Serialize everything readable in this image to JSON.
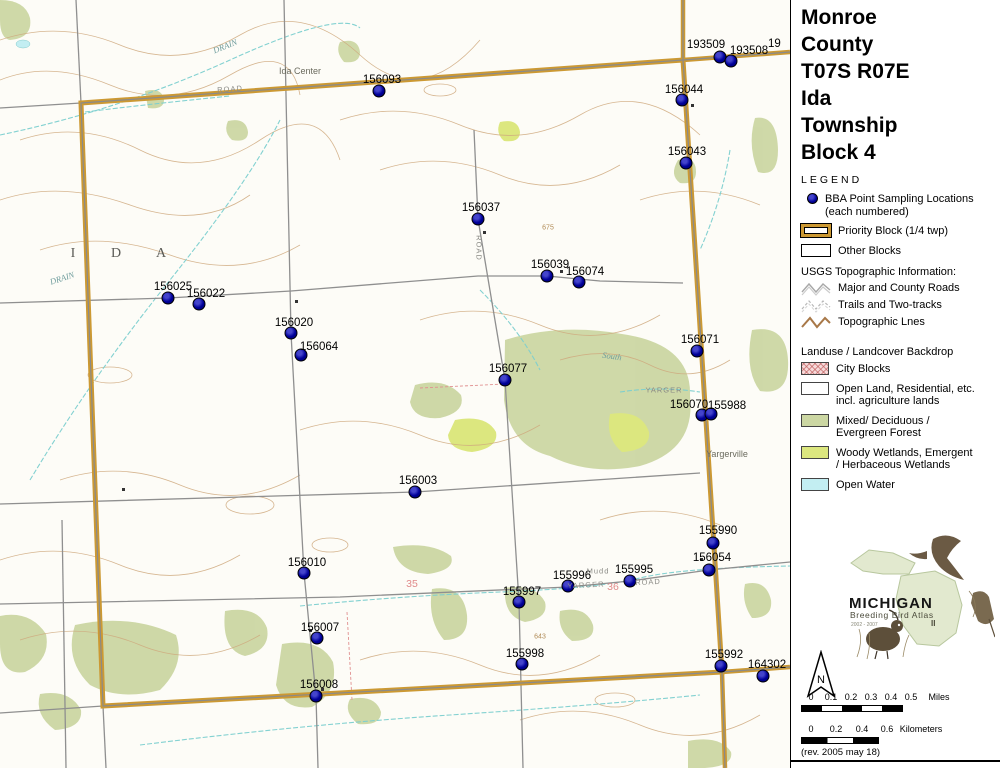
{
  "title": {
    "lines": [
      "Monroe",
      "County",
      "T07S R07E",
      "Ida",
      "Township",
      "Block 4"
    ],
    "legend_heading": "LEGEND"
  },
  "legend": {
    "bba": {
      "label_line1": "BBA Point Sampling Locations",
      "label_line2": "(each numbered)"
    },
    "priority": "Priority Block (1/4 twp)",
    "other": "Other Blocks",
    "usgs_heading": "USGS Topographic Information:",
    "usgs_items": [
      "Major and County Roads",
      "Trails and Two-tracks",
      "Topographic Lnes"
    ],
    "landuse_heading": "Landuse / Landcover Backdrop",
    "landuse_items": [
      {
        "lines": [
          "City Blocks"
        ]
      },
      {
        "lines": [
          "Open Land, Residential, etc.",
          "incl. agriculture lands"
        ]
      },
      {
        "lines": [
          "Mixed/ Deciduous /",
          "Evergreen Forest"
        ]
      },
      {
        "lines": [
          "Woody Wetlands, Emergent",
          "/ Herbaceous Wetlands"
        ]
      },
      {
        "lines": [
          "Open Water"
        ]
      }
    ]
  },
  "colors": {
    "priority_block": "#cc9933",
    "point_dot": "#000099",
    "forest": "#ccd7a3",
    "wetland": "#dce77f",
    "open_water": "#c3eef2",
    "city": "#f6dada",
    "contour": "#cfa97e",
    "road_gray": "#909090",
    "stream": "#7ccfcf"
  },
  "points": [
    {
      "id": "156093",
      "x": 379,
      "y": 91,
      "lx": 382,
      "ly": 80
    },
    {
      "id": "193509",
      "x": 720,
      "y": 57,
      "lx": 706,
      "ly": 45
    },
    {
      "id": "193508",
      "x": 731,
      "y": 61,
      "lx": 749,
      "ly": 51
    },
    {
      "id": "156044",
      "x": 682,
      "y": 100,
      "lx": 684,
      "ly": 90
    },
    {
      "id": "156043",
      "x": 686,
      "y": 163,
      "lx": 687,
      "ly": 152
    },
    {
      "id": "156037",
      "x": 478,
      "y": 219,
      "lx": 481,
      "ly": 208
    },
    {
      "id": "156039",
      "x": 547,
      "y": 276,
      "lx": 550,
      "ly": 265
    },
    {
      "id": "156074",
      "x": 579,
      "y": 282,
      "lx": 585,
      "ly": 272
    },
    {
      "id": "156025",
      "x": 168,
      "y": 298,
      "lx": 173,
      "ly": 287
    },
    {
      "id": "156022",
      "x": 199,
      "y": 304,
      "lx": 206,
      "ly": 294
    },
    {
      "id": "156020",
      "x": 291,
      "y": 333,
      "lx": 294,
      "ly": 323
    },
    {
      "id": "156064",
      "x": 301,
      "y": 355,
      "lx": 319,
      "ly": 347
    },
    {
      "id": "156077",
      "x": 505,
      "y": 380,
      "lx": 508,
      "ly": 369
    },
    {
      "id": "156071",
      "x": 697,
      "y": 351,
      "lx": 700,
      "ly": 340
    },
    {
      "id": "156070",
      "x": 702,
      "y": 415,
      "lx": 689,
      "ly": 405
    },
    {
      "id": "155988",
      "x": 711,
      "y": 414,
      "lx": 727,
      "ly": 406
    },
    {
      "id": "156003",
      "x": 415,
      "y": 492,
      "lx": 418,
      "ly": 481
    },
    {
      "id": "155990",
      "x": 713,
      "y": 543,
      "lx": 718,
      "ly": 531
    },
    {
      "id": "156054",
      "x": 709,
      "y": 570,
      "lx": 712,
      "ly": 558
    },
    {
      "id": "155996",
      "x": 568,
      "y": 586,
      "lx": 572,
      "ly": 576
    },
    {
      "id": "155995",
      "x": 630,
      "y": 581,
      "lx": 634,
      "ly": 570
    },
    {
      "id": "155997",
      "x": 519,
      "y": 602,
      "lx": 522,
      "ly": 592
    },
    {
      "id": "156010",
      "x": 304,
      "y": 573,
      "lx": 307,
      "ly": 563
    },
    {
      "id": "156007",
      "x": 317,
      "y": 638,
      "lx": 320,
      "ly": 628
    },
    {
      "id": "155998",
      "x": 522,
      "y": 664,
      "lx": 525,
      "ly": 654
    },
    {
      "id": "156008",
      "x": 316,
      "y": 696,
      "lx": 319,
      "ly": 685
    },
    {
      "id": "155992",
      "x": 721,
      "y": 666,
      "lx": 724,
      "ly": 655
    },
    {
      "id": "164302",
      "x": 763,
      "y": 676,
      "lx": 767,
      "ly": 665
    }
  ],
  "edge_label": {
    "text": "19"
  },
  "map_labels": [
    {
      "text": "I",
      "x": 73,
      "y": 254,
      "cls": "twp"
    },
    {
      "text": "D",
      "x": 116,
      "y": 254,
      "cls": "twp"
    },
    {
      "text": "A",
      "x": 161,
      "y": 254,
      "cls": "twp"
    },
    {
      "text": "Ida Center",
      "x": 300,
      "y": 71,
      "cls": "place"
    },
    {
      "text": "Yargerville",
      "x": 727,
      "y": 454,
      "cls": "place"
    },
    {
      "text": "ROAD",
      "x": 230,
      "y": 89,
      "cls": "road",
      "rot": -4
    },
    {
      "text": "ROAD",
      "x": 479,
      "y": 248,
      "cls": "road",
      "rot": 90
    },
    {
      "text": "ROAD",
      "x": 648,
      "y": 582,
      "cls": "road",
      "rot": -3
    },
    {
      "text": "YARGER",
      "x": 664,
      "y": 390,
      "cls": "road"
    },
    {
      "text": "YARGER",
      "x": 586,
      "y": 585,
      "cls": "road",
      "rot": -3
    },
    {
      "text": "Mudd",
      "x": 598,
      "y": 571,
      "cls": "road"
    },
    {
      "text": "DRAIN",
      "x": 225,
      "y": 46,
      "cls": "stream-label",
      "rot": -22
    },
    {
      "text": "DRAIN",
      "x": 62,
      "y": 278,
      "cls": "stream-label",
      "rot": -18
    },
    {
      "text": "South",
      "x": 612,
      "y": 356,
      "cls": "stream-label",
      "rot": 8
    },
    {
      "text": "675",
      "x": 548,
      "y": 228,
      "cls": "contour-label"
    },
    {
      "text": "643",
      "x": 540,
      "y": 637,
      "cls": "contour-label"
    },
    {
      "text": "35",
      "x": 412,
      "y": 584,
      "cls": "section"
    },
    {
      "text": "36",
      "x": 613,
      "y": 587,
      "cls": "section"
    }
  ],
  "logo": {
    "name": "MICHIGAN",
    "subtitle": "Breeding Bird Atlas",
    "numeral": "II",
    "years": "2002 - 2007"
  },
  "north_arrow": {
    "label": "N"
  },
  "scale": {
    "miles": {
      "ticks": [
        "0",
        "0.1",
        "0.2",
        "0.3",
        "0.4",
        "0.5"
      ],
      "unit": "Miles"
    },
    "km": {
      "ticks": [
        "0",
        "0.2",
        "0.4",
        "0.6"
      ],
      "unit": "Kilometers"
    }
  },
  "revision": "(rev. 2005 may 18)"
}
